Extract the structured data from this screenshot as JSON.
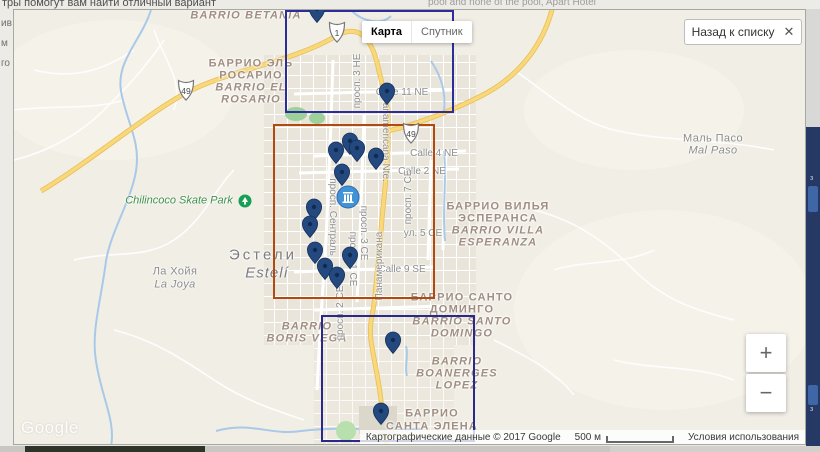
{
  "background": {
    "top_left_text": "тры помогут вам найти отличный вариант",
    "top_right_text": "pool and none of the pool, Apart Hotel",
    "left_fragments": [
      "ив",
      "м",
      "го"
    ],
    "right_fragments": [
      "з",
      "з"
    ]
  },
  "controls": {
    "map_type": {
      "map": "Карта",
      "satellite": "Спутник"
    },
    "back_button": {
      "label": "Назад к списку",
      "close": "✕"
    },
    "zoom": {
      "zoom_in": "+",
      "zoom_out": "−"
    },
    "watermark": "Google",
    "attribution": {
      "data_text": "Картографические данные © 2017 Google",
      "scale": "500 м",
      "terms": "Условия использования"
    }
  },
  "map": {
    "pin_color": "#24497f",
    "cluster_color": "#4292d6",
    "labels": [
      {
        "t": "BARRIO BETANIA",
        "x": 232,
        "y": 6,
        "k": "barrio-lat"
      },
      {
        "t": "БАРРИО ЭЛЬ",
        "x": 237,
        "y": 54,
        "k": "barrio"
      },
      {
        "t": "РОСАРИО",
        "x": 237,
        "y": 66,
        "k": "barrio"
      },
      {
        "t": "BARRIO EL",
        "x": 237,
        "y": 78,
        "k": "barrio-lat"
      },
      {
        "t": "ROSARIO",
        "x": 237,
        "y": 90,
        "k": "barrio-lat"
      },
      {
        "t": "Маль Пасо",
        "x": 699,
        "y": 129,
        "k": "town"
      },
      {
        "t": "Mal Paso",
        "x": 699,
        "y": 141,
        "k": "town-lat"
      },
      {
        "t": "Chilincoco Skate Park",
        "x": 165,
        "y": 191,
        "k": "park"
      },
      {
        "t": "БАРРИО ВИЛЬЯ",
        "x": 484,
        "y": 197,
        "k": "barrio"
      },
      {
        "t": "ЭСПЕРАНСА",
        "x": 484,
        "y": 209,
        "k": "barrio"
      },
      {
        "t": "BARRIO VILLA",
        "x": 484,
        "y": 221,
        "k": "barrio-lat"
      },
      {
        "t": "ESPERANZA",
        "x": 484,
        "y": 233,
        "k": "barrio-lat"
      },
      {
        "t": "Эстели",
        "x": 249,
        "y": 245,
        "k": "city"
      },
      {
        "t": "Estelí",
        "x": 253,
        "y": 263,
        "k": "city-lat"
      },
      {
        "t": "Ла Хойя",
        "x": 161,
        "y": 262,
        "k": "town"
      },
      {
        "t": "La Joya",
        "x": 161,
        "y": 275,
        "k": "town-lat"
      },
      {
        "t": "БАРРИО САНТО",
        "x": 448,
        "y": 288,
        "k": "barrio"
      },
      {
        "t": "ДОМИНГО",
        "x": 448,
        "y": 300,
        "k": "barrio"
      },
      {
        "t": "BARRIO SANTO",
        "x": 448,
        "y": 312,
        "k": "barrio-lat"
      },
      {
        "t": "DOMINGO",
        "x": 448,
        "y": 324,
        "k": "barrio-lat"
      },
      {
        "t": "BARRIO",
        "x": 293,
        "y": 317,
        "k": "barrio-lat"
      },
      {
        "t": "BORIS VEGA",
        "x": 293,
        "y": 329,
        "k": "barrio-lat"
      },
      {
        "t": "BARRIO",
        "x": 443,
        "y": 352,
        "k": "barrio-lat"
      },
      {
        "t": "BOANERGES",
        "x": 443,
        "y": 364,
        "k": "barrio-lat"
      },
      {
        "t": "LOPEZ",
        "x": 443,
        "y": 376,
        "k": "barrio-lat"
      },
      {
        "t": "БАРРИО",
        "x": 418,
        "y": 404,
        "k": "barrio"
      },
      {
        "t": "САНТА ЭЛЕНА",
        "x": 418,
        "y": 417,
        "k": "barrio"
      },
      {
        "t": "Calle 11 NE",
        "x": 388,
        "y": 83,
        "k": "road"
      },
      {
        "t": "Calle 4 NE",
        "x": 420,
        "y": 144,
        "k": "road"
      },
      {
        "t": "Calle 2 NE",
        "x": 408,
        "y": 162,
        "k": "road"
      },
      {
        "t": "ул. 5 СЕ",
        "x": 409,
        "y": 224,
        "k": "road"
      },
      {
        "t": "Calle 9 SE",
        "x": 388,
        "y": 260,
        "k": "road"
      },
      {
        "t": "просп. 3 НЕ",
        "x": 344,
        "y": 71,
        "k": "road",
        "r": -90
      },
      {
        "t": "Panamericana Nte.",
        "x": 371,
        "y": 129,
        "k": "road",
        "r": 90
      },
      {
        "t": "просп. 7 СЕ",
        "x": 395,
        "y": 187,
        "k": "road",
        "r": -90
      },
      {
        "t": "просп. Сентраль",
        "x": 318,
        "y": 207,
        "k": "road",
        "r": 90
      },
      {
        "t": "просп. 3 СЕ",
        "x": 349,
        "y": 223,
        "k": "road",
        "r": 90
      },
      {
        "t": "просп. 1 СЕ",
        "x": 338,
        "y": 249,
        "k": "road",
        "r": 90
      },
      {
        "t": "Панамерикана",
        "x": 366,
        "y": 256,
        "k": "road",
        "r": -90
      },
      {
        "t": "просп. 2 СЕ",
        "x": 327,
        "y": 303,
        "k": "road",
        "r": -90
      }
    ],
    "route_shields": [
      {
        "n": "49",
        "x": 172,
        "y": 81
      },
      {
        "n": "1",
        "x": 323,
        "y": 23
      },
      {
        "n": "49",
        "x": 397,
        "y": 124
      }
    ],
    "pins": [
      [
        303,
        -1
      ],
      [
        373,
        81
      ],
      [
        322,
        140
      ],
      [
        336,
        131
      ],
      [
        343,
        138
      ],
      [
        362,
        146
      ],
      [
        328,
        162
      ],
      [
        300,
        197
      ],
      [
        296,
        214
      ],
      [
        301,
        240
      ],
      [
        311,
        256
      ],
      [
        336,
        245
      ],
      [
        323,
        265
      ],
      [
        379,
        330
      ],
      [
        367,
        401
      ]
    ],
    "cluster": {
      "x": 334,
      "y": 187,
      "icon": "hotel-building"
    },
    "selection_rectangles": [
      {
        "x": 272,
        "y": 1,
        "w": 167,
        "h": 101,
        "color": "#2d2d9a"
      },
      {
        "x": 260,
        "y": 115,
        "w": 160,
        "h": 173,
        "color": "#b14a10"
      },
      {
        "x": 308,
        "y": 306,
        "w": 152,
        "h": 125,
        "color": "#29298b"
      }
    ]
  }
}
